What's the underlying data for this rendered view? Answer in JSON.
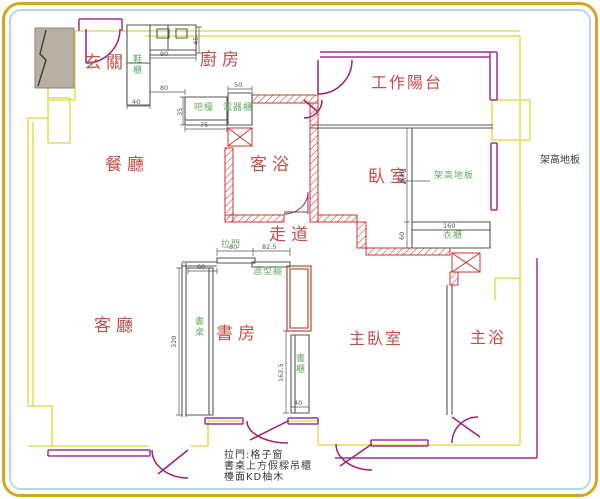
{
  "palette": {
    "room_label_red": "#c0504a",
    "annotation_green": "#69aa69",
    "wall_hatch_red": "#cc3333",
    "structure_yellow": "#e6dd55",
    "window_purple": "#993399",
    "door_magenta": "#a02070",
    "dimension_gray": "#555555",
    "border_gold": "#d9a520",
    "border_blue": "#b5d8e8"
  },
  "rooms": {
    "entrance": "玄關",
    "kitchen": "廚房",
    "work_balcony": "工作陽台",
    "dining": "餐廳",
    "guest_bath": "客浴",
    "bedroom": "臥室",
    "corridor": "走道",
    "living": "客廳",
    "study": "書房",
    "master_bedroom": "主臥室",
    "master_bath": "主浴"
  },
  "annotations": {
    "shoe_cabinet": "鞋櫃",
    "bar_counter": "吧檯",
    "appliance_cabinet": "電器櫃",
    "sliding_door": "拉門",
    "feature_wall": "造型牆",
    "desk": "書桌",
    "bookcase": "書櫃",
    "raised_floor": "架高地板",
    "wardrobe": "衣櫃",
    "raised_floor_side": "架高地板"
  },
  "notes": [
    "拉門:格子窗",
    "書桌上方假樑吊櫃",
    "檯面KD柚木"
  ],
  "dimensions": [
    "90",
    "45",
    "80",
    "40",
    "35",
    "75",
    "50",
    "60",
    "80",
    "82.5",
    "320",
    "162.5",
    "40",
    "240",
    "60",
    "160"
  ]
}
